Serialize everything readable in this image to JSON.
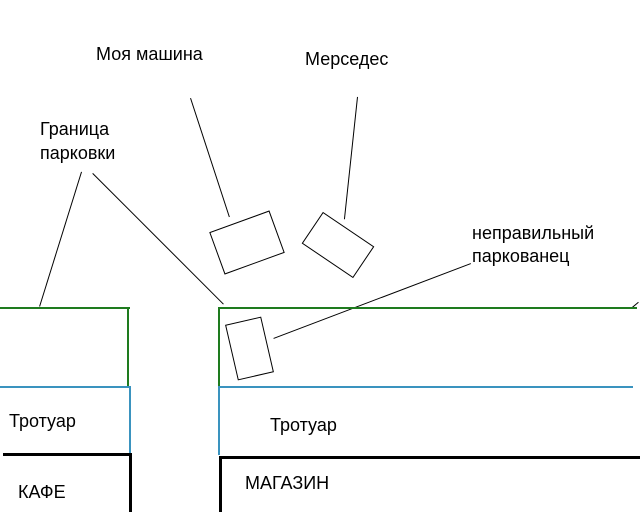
{
  "drawing_title": "Parking situation sketch",
  "colors": {
    "parking_boundary_green": "#1e7b1e",
    "sidewalk_blue": "#3a93bf",
    "building_black": "#000000",
    "annotation_black": "#000000",
    "background": "#ffffff"
  },
  "labels": {
    "my_car": "Моя машина",
    "mercedes": "Мерседес",
    "parking_boundary": "Граница\nпарковки",
    "wrong_parker": "неправильный\nпаркованец",
    "sidewalk_left": "Тротуар",
    "sidewalk_right": "Тротуар",
    "cafe": "КАФЕ",
    "shop": "МАГАЗИН"
  },
  "shapes": {
    "my_car_rect": "rotated rectangle (car seen from above)",
    "mercedes_rect": "rotated rectangle (car seen from above)",
    "wrong_parker_rect": "rotated rectangle parked across boundary"
  }
}
